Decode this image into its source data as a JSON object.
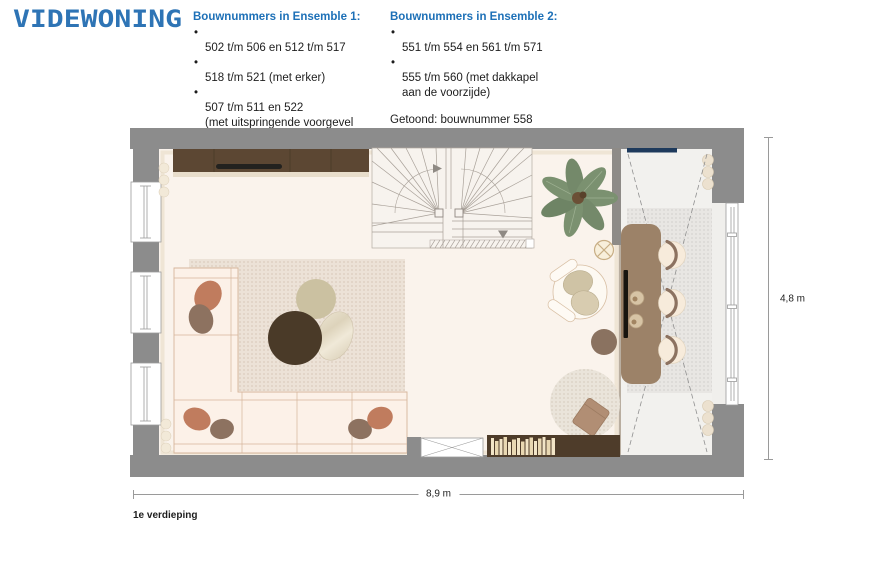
{
  "logo_text": "VIDEWONING",
  "bullet_char": "•",
  "columns": [
    {
      "title": "Bouwnummers in Ensemble 1:",
      "items": [
        "502 t/m 506 en 512 t/m 517",
        "518 t/m 521 (met erker)",
        "507 t/m 511 en 522\n(met uitspringende voorgevel\nover 3 woonlagen)"
      ]
    },
    {
      "title": "Bouwnummers in Ensemble 2:",
      "items": [
        "551 t/m 554 en 561 t/m 571",
        "555 t/m 560 (met dakkapel\naan de voorzijde)"
      ],
      "note": "Getoond: bouwnummer 558"
    }
  ],
  "plan": {
    "floor_label": "1e verdieping",
    "width_label": "8,9 m",
    "height_label": "4,8 m"
  },
  "colors": {
    "brand_blue": "#2e74b5",
    "heading_blue": "#1d70b7",
    "text_dark": "#1d1d1d",
    "wall_gray": "#8c8c8c",
    "floor_cream": "#faf3ec",
    "vide_floor": "#f2f1ee",
    "accent_navy": "#1e3a5c",
    "cabinet_brown": "#5c4733",
    "table_brown": "#9c8268",
    "sofa_cream": "#fcf1e8",
    "cushion_terracotta": "#c07c5e",
    "cushion_brown": "#8d7260",
    "rug_circle_dark": "#4a3a28",
    "plant_green": "#7b9170",
    "dimension_line": "#9a9a9a"
  }
}
